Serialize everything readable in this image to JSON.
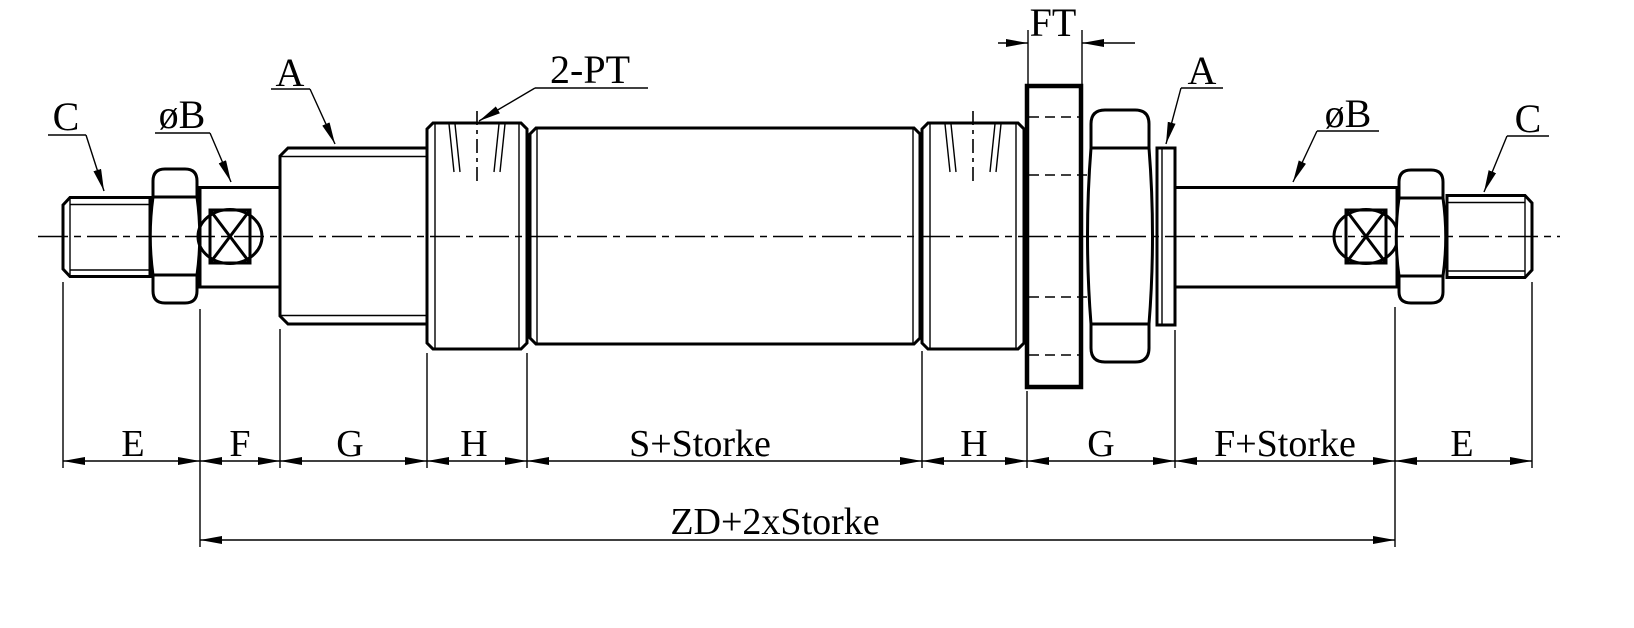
{
  "colors": {
    "ink": "#000000",
    "paper": "#ffffff"
  },
  "callouts": {
    "rod_thread_left": "C",
    "rod_dia_left": "øB",
    "boss_left": "A",
    "ports": "2-PT",
    "flange_thickness": "FT",
    "boss_right": "A",
    "rod_dia_right": "øB",
    "rod_thread_right": "C"
  },
  "dimensions": {
    "e_left": "E",
    "f_left": "F",
    "g_left": "G",
    "h_left": "H",
    "s_stroke": "S+Storke",
    "h_right": "H",
    "g_right": "G",
    "f_stroke": "F+Storke",
    "e_right": "E",
    "overall": "ZD+2xStorke"
  }
}
